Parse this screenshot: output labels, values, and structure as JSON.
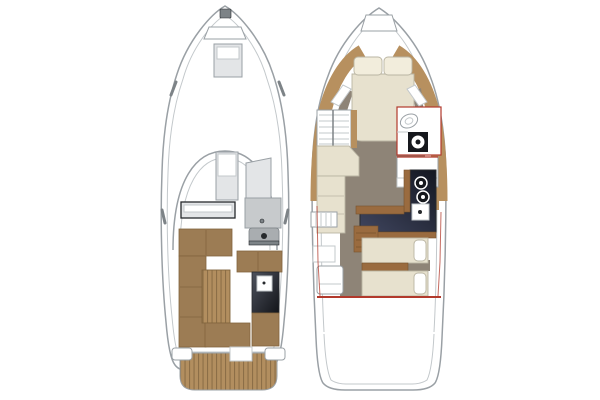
{
  "window": {
    "title": "Yacht two-deck floor plan diagram",
    "width": 600,
    "height": 400,
    "background": "#ffffff"
  },
  "colors": {
    "white": "#ffffff",
    "hull_stroke": "#9aa0a5",
    "inner_stroke": "#c3c8cb",
    "fitting": "#7d8387",
    "dark": "#26292c",
    "light_gray": "#e3e5e7",
    "console_gray": "#c7cacc",
    "console_gray_dark": "#a9adb0",
    "seat_brown": "#9c7c54",
    "seat_brown_edge": "#82653e",
    "teak": "#b28e5f",
    "teak_line": "#8c6e47",
    "tan_band": "#b7905f",
    "wood": "#9a6b3f",
    "wood_dark": "#77522e",
    "cream": "#e7e1ce",
    "cream_edge": "#bab5a3",
    "pillow": "#f2eddc",
    "taupe": "#8e8477",
    "counter_hi": "#3f455e",
    "counter_dark": "#141721",
    "bar_hi": "#4e525d",
    "bar_dark": "#121419",
    "black_unit": "#16181d",
    "red": "#b2392c"
  },
  "plans": [
    {
      "id": "main-deck",
      "label": "Main deck exterior plan",
      "features": [
        "bow anchor fitting",
        "anchor locker",
        "foredeck hatch",
        "side cleats",
        "windshield arch",
        "companionway post",
        "port storage locker",
        "helm console",
        "helm seat",
        "port L-shaped sofa",
        "teak cockpit table",
        "starboard bench seats",
        "wet bar unit",
        "starboard aft cushion",
        "aft bench",
        "transom walkway",
        "stern cleats",
        "teak swim platform"
      ]
    },
    {
      "id": "lower-deck",
      "label": "Lower deck interior plan",
      "features": [
        "anchor locker",
        "v-berth double bed with pillows",
        "bow side shelves",
        "companionway stairs",
        "head compartment with toilet and sink",
        "port settee",
        "starboard wardrobe",
        "L-shaped galley counter with cooktop burners and sink",
        "galley steps",
        "side locker",
        "aft cabin twin beds with pillows",
        "aft cabin cabinet",
        "aft bulkhead",
        "stern platform"
      ]
    }
  ]
}
